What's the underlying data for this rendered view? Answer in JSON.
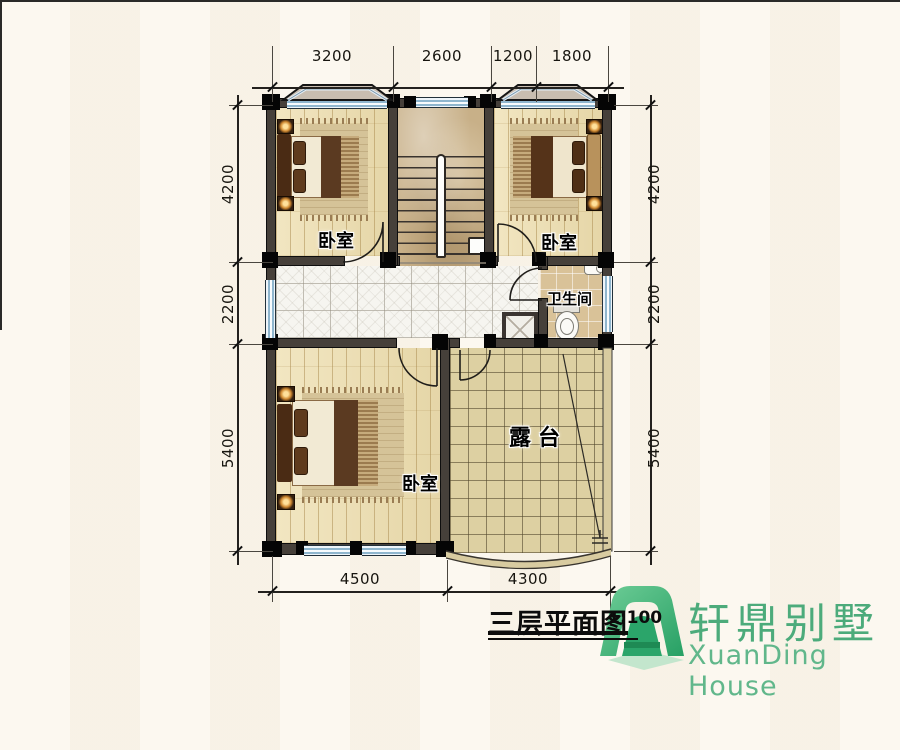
{
  "page": {
    "background": "#faf5ea"
  },
  "dimensions": {
    "top": [
      "3200",
      "2600",
      "1200",
      "1800"
    ],
    "left": [
      "4200",
      "2200",
      "5400"
    ],
    "right": [
      "4200",
      "2200",
      "5400"
    ],
    "bottom": [
      "4500",
      "4300"
    ]
  },
  "rooms": {
    "bedroom_top_left": {
      "label": "卧室"
    },
    "bedroom_top_right": {
      "label": "卧室"
    },
    "bedroom_bottom": {
      "label": "卧室"
    },
    "bathroom": {
      "label": "卫生间"
    },
    "terrace": {
      "label": "露台"
    }
  },
  "title_block": {
    "title": "三层平面图",
    "scale": "1:100"
  },
  "logo": {
    "name_cn": "轩鼎别墅",
    "name_en": "XuanDing House",
    "green": "#3fae7d"
  },
  "colors": {
    "wall": "#1a1a1a",
    "wood_floor": "#eedfb0",
    "marble_floor": "#c8b088",
    "hall_tile": "#f6f5f0",
    "bath_tile": "#d9c298",
    "terrace_tile": "#ddd0a2",
    "window_glass": "#cfe4f2",
    "dimension_text": "#17150f"
  }
}
